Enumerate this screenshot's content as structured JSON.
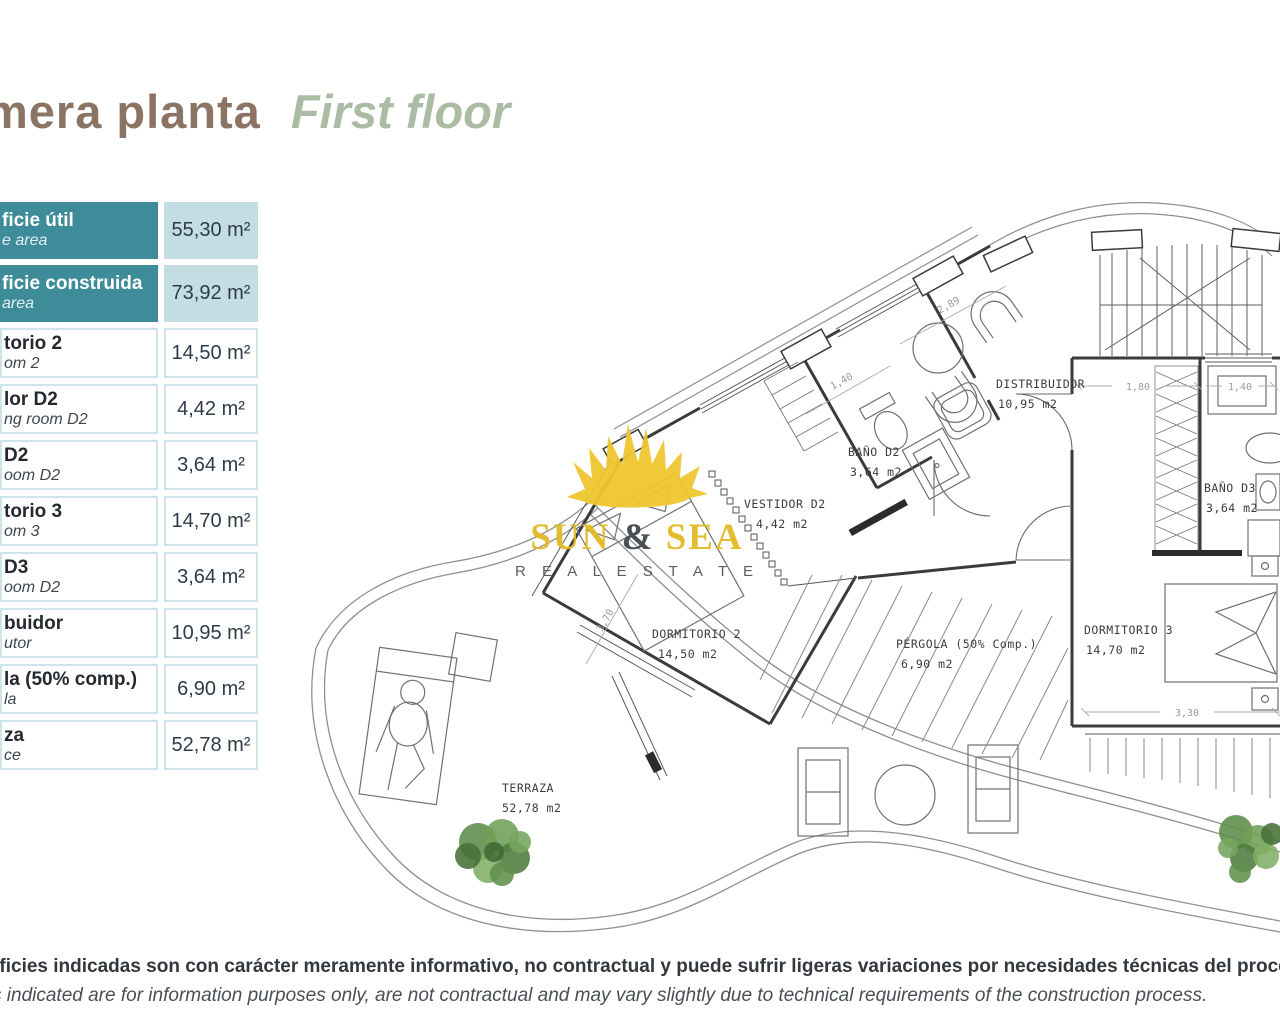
{
  "page": {
    "title_es": "mera planta",
    "title_en": "First floor"
  },
  "areas_table": {
    "rows": [
      {
        "label_es": "ficie útil",
        "label_en": "e area",
        "value": "55,30 m²"
      },
      {
        "label_es": "ficie construida",
        "label_en": "area",
        "value": "73,92 m²"
      },
      {
        "label_es": "torio 2",
        "label_en": "om 2",
        "value": "14,50 m²"
      },
      {
        "label_es": "lor D2",
        "label_en": "ng room D2",
        "value": "4,42 m²"
      },
      {
        "label_es": "D2",
        "label_en": "oom D2",
        "value": "3,64 m²"
      },
      {
        "label_es": "torio 3",
        "label_en": "om 3",
        "value": "14,70 m²"
      },
      {
        "label_es": "D3",
        "label_en": "oom D2",
        "value": "3,64 m²"
      },
      {
        "label_es": "buidor",
        "label_en": "utor",
        "value": "10,95 m²"
      },
      {
        "label_es": "la (50% comp.)",
        "label_en": "la",
        "value": "6,90 m²"
      },
      {
        "label_es": "za",
        "label_en": "ce",
        "value": "52,78 m²"
      }
    ]
  },
  "floorplan": {
    "rooms": [
      {
        "name": "DORMITORIO 2",
        "area": "14,50 m2"
      },
      {
        "name": "VESTIDOR D2",
        "area": "4,42 m2"
      },
      {
        "name": "BAÑO D2",
        "area": "3,64 m2"
      },
      {
        "name": "DISTRIBUIDOR",
        "area": "10,95 m2"
      },
      {
        "name": "BAÑO D3",
        "area": "3,64 m2"
      },
      {
        "name": "DORMITORIO 3",
        "area": "14,70 m2"
      },
      {
        "name": "PÉRGOLA (50% Comp.)",
        "area": "6,90 m2"
      },
      {
        "name": "TERRAZA",
        "area": "52,78 m2"
      }
    ],
    "dimensions": [
      "1,40",
      "2,89",
      "1,80",
      "1,40",
      "3,30",
      "3,70"
    ]
  },
  "logo": {
    "sun": "SUN",
    "amp": " & ",
    "sea": "SEA",
    "tagline": "R E A L   E S T A T E"
  },
  "footer": {
    "es": "rficies indicadas son con carácter meramente informativo, no contractual y puede sufrir ligeras variaciones por necesidades técnicas del proceso de construcción",
    "en": "s indicated are for information purposes only, are not contractual and may vary slightly due to technical requirements of the construction process."
  },
  "colors": {
    "teal": "#3e8c99",
    "light_blue": "#c3dde3",
    "cell_border": "#cde4ea",
    "title_brown": "#8b7463",
    "title_sage": "#aabca4",
    "logo_yellow": "#e9c430",
    "plan_wall": "#3b3b3b"
  }
}
